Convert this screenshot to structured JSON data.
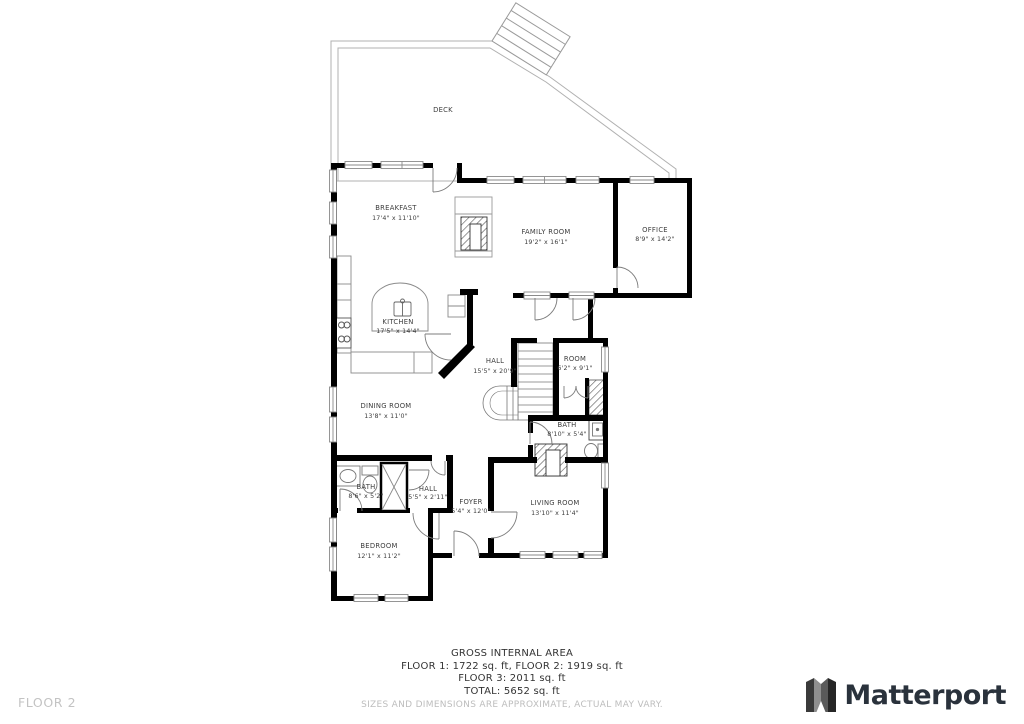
{
  "floor_label": "FLOOR 2",
  "deck_label": "DECK",
  "rooms": [
    {
      "name": "BREAKFAST",
      "dims": "17'4\" x 11'10\""
    },
    {
      "name": "FAMILY ROOM",
      "dims": "19'2\" x 16'1\""
    },
    {
      "name": "OFFICE",
      "dims": "8'9\" x 14'2\""
    },
    {
      "name": "KITCHEN",
      "dims": "17'5\" x 14'4\""
    },
    {
      "name": "HALL",
      "dims": "15'5\" x 20'9\""
    },
    {
      "name": "ROOM",
      "dims": "6'2\" x 9'1\""
    },
    {
      "name": "DINING ROOM",
      "dims": "13'8\" x 11'0\""
    },
    {
      "name": "BATH",
      "dims": "8'10\" x 5'4\""
    },
    {
      "name": "LIVING ROOM",
      "dims": "13'10\" x 11'4\""
    },
    {
      "name": "FOYER",
      "dims": "5'4\" x 12'0\""
    },
    {
      "name": "BATH",
      "dims": "8'6\" x 5'2\""
    },
    {
      "name": "HALL",
      "dims": "5'5\" x 2'11\""
    },
    {
      "name": "BEDROOM",
      "dims": "12'1\" x 11'2\""
    }
  ],
  "footer": {
    "area_title": "GROSS INTERNAL AREA",
    "line1": "FLOOR 1: 1722 sq. ft, FLOOR 2: 1919 sq. ft",
    "line2": "FLOOR 3: 2011 sq. ft",
    "line3": "TOTAL: 5652 sq. ft",
    "disclaimer": "SIZES AND DIMENSIONS ARE APPROXIMATE, ACTUAL MAY VARY."
  },
  "brand": {
    "name": "Matterport"
  },
  "colors": {
    "wall": "#000000",
    "deck_outline": "#b0b0b0",
    "label_text": "#3d3d3d",
    "muted_text": "#bdbdbd",
    "brand_text": "#2a323c"
  }
}
